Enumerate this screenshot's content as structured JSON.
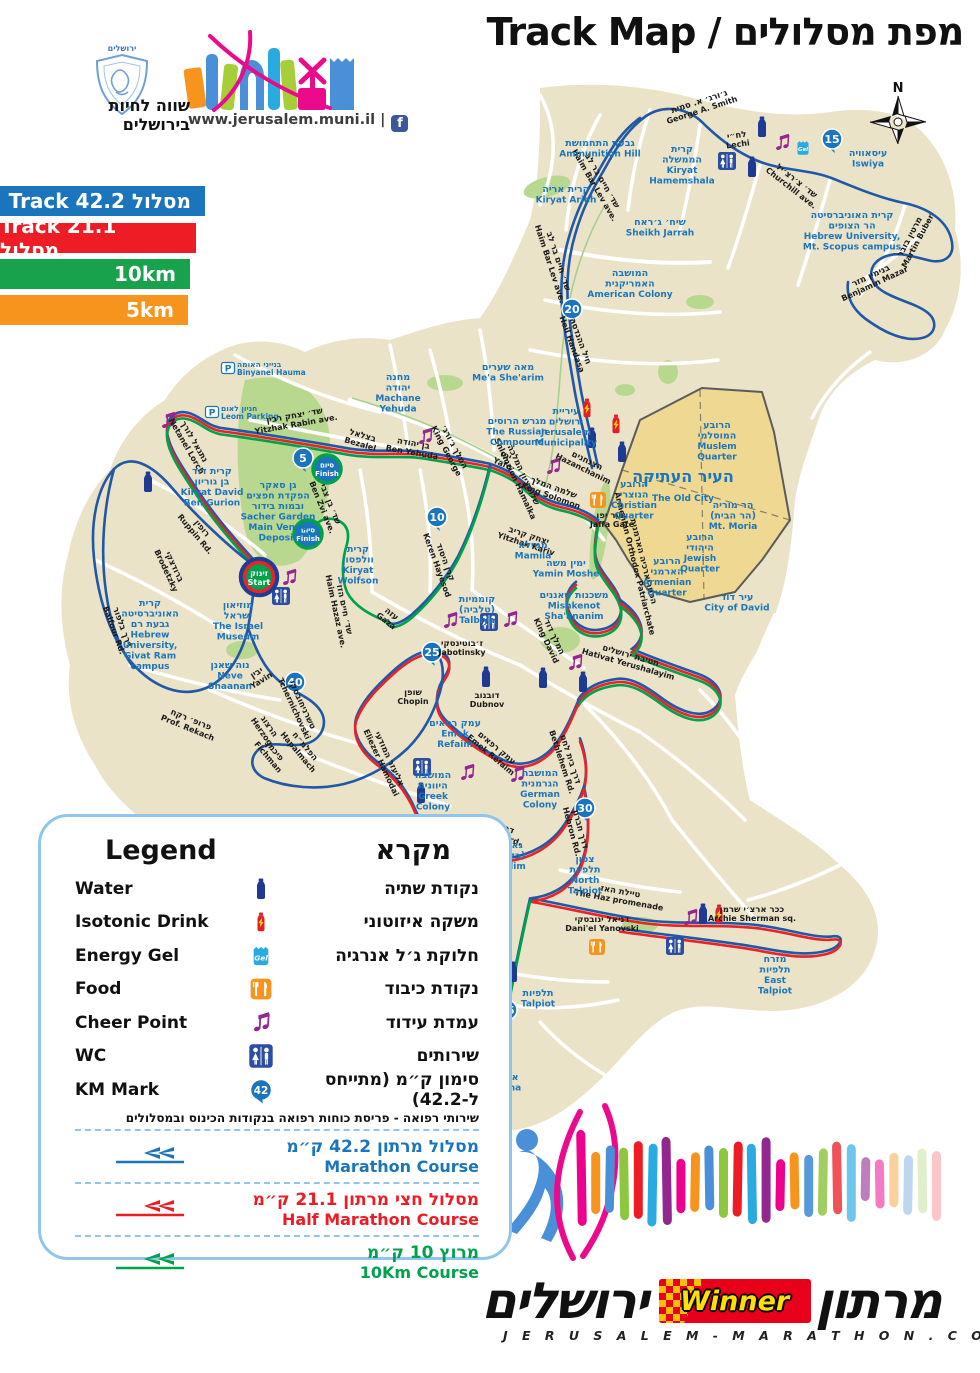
{
  "theme": {
    "map_bg": "#EBE3C8",
    "park": "#B9D88F",
    "old_city_fill": "#EFD892",
    "old_city_border": "#5B5B5B",
    "label_blue": "#1B75BC",
    "street_black": "#1A1A1A",
    "road_white": "#FFFFFF",
    "route_colors": {
      "blue": "#2158A6",
      "red": "#E8232A",
      "green": "#00A14B"
    },
    "ribbon_blue": "#1B75BC",
    "ribbon_red": "#EE1C25",
    "ribbon_green": "#18A24C",
    "ribbon_orange": "#F7941E"
  },
  "header": {
    "title": "Track Map / מפת מסלולים",
    "compass_n": "N",
    "logo_top": "ירושלים",
    "slogan_line1": "שווה לחיות",
    "slogan_line2": "בירושלים",
    "site": "www.jerusalem.muni.il |",
    "fb": "f"
  },
  "ribbons": [
    {
      "label": "Track 42.2 מסלול",
      "color": "#1B75BC",
      "width": 205,
      "top": 186
    },
    {
      "label": "Track 21.1 מסלול",
      "color": "#EE1C25",
      "width": 196,
      "top": 223
    },
    {
      "label": "10km",
      "color": "#18A24C",
      "width": 190,
      "top": 259
    },
    {
      "label": "5km",
      "color": "#F7941E",
      "width": 188,
      "top": 295
    }
  ],
  "legend": {
    "title_en": "Legend",
    "title_he": "מקרא",
    "items": [
      {
        "en": "Water",
        "he": "נקודת שתיה",
        "icon": "water"
      },
      {
        "en": "Isotonic Drink",
        "he": "משקה איזוטוני",
        "icon": "isotonic"
      },
      {
        "en": "Energy Gel",
        "he": "חלוקת ג׳ל אנרגיה",
        "icon": "gel"
      },
      {
        "en": "Food",
        "he": "נקודת כיבוד",
        "icon": "food"
      },
      {
        "en": "Cheer Point",
        "he": "עמדת עידוד",
        "icon": "cheer"
      },
      {
        "en": "WC",
        "he": "שירותים",
        "icon": "wc"
      },
      {
        "en": "KM Mark",
        "he": "סימון ק״מ (מתייחס ל-42.2)",
        "icon": "km",
        "badge": "42"
      }
    ],
    "note": "שירותי רפואה - פריסת כוחות רפואה בנקודות הכינוס ובמסלולים",
    "courses": [
      {
        "he": "מסלול מרתון 42.2 ק״מ",
        "en": "Marathon Course",
        "color": "blue"
      },
      {
        "he": "מסלול חצי מרתון 21.1 ק״מ",
        "en": "Half Marathon Course",
        "color": "red"
      },
      {
        "he": "מרוץ 10 ק״מ",
        "en": "10Km Course",
        "color": "green"
      }
    ]
  },
  "footer": {
    "brand_left": "ירושלים",
    "brand_right": "מרתון",
    "winner": "Winner",
    "url": "J E R U S A L E M - M A R A T H O N . C O M"
  },
  "map": {
    "start": {
      "x": 259,
      "y": 577,
      "he": "זינוק",
      "en": "Start"
    },
    "finishes": [
      {
        "x": 327,
        "y": 469,
        "he": "סיום",
        "en": "Finish"
      },
      {
        "x": 308,
        "y": 534,
        "he": "סיום",
        "en": "Finish"
      }
    ],
    "km_marks": [
      {
        "n": "5",
        "x": 303,
        "y": 458
      },
      {
        "n": "10",
        "x": 437,
        "y": 517
      },
      {
        "n": "15",
        "x": 832,
        "y": 139
      },
      {
        "n": "20",
        "x": 572,
        "y": 309
      },
      {
        "n": "25",
        "x": 432,
        "y": 652
      },
      {
        "n": "30",
        "x": 585,
        "y": 808
      },
      {
        "n": "35",
        "x": 507,
        "y": 1010
      },
      {
        "n": "40",
        "x": 295,
        "y": 682
      }
    ],
    "icons": [
      {
        "t": "wc",
        "x": 727,
        "y": 161
      },
      {
        "t": "wc",
        "x": 281,
        "y": 596
      },
      {
        "t": "wc",
        "x": 489,
        "y": 622
      },
      {
        "t": "wc",
        "x": 422,
        "y": 767
      },
      {
        "t": "wc",
        "x": 675,
        "y": 946
      },
      {
        "t": "water",
        "x": 762,
        "y": 127
      },
      {
        "t": "water",
        "x": 752,
        "y": 167
      },
      {
        "t": "water",
        "x": 148,
        "y": 482
      },
      {
        "t": "water",
        "x": 592,
        "y": 438
      },
      {
        "t": "water",
        "x": 622,
        "y": 452
      },
      {
        "t": "water",
        "x": 486,
        "y": 677
      },
      {
        "t": "water",
        "x": 543,
        "y": 678
      },
      {
        "t": "water",
        "x": 583,
        "y": 682
      },
      {
        "t": "water",
        "x": 421,
        "y": 793
      },
      {
        "t": "water",
        "x": 494,
        "y": 963
      },
      {
        "t": "water",
        "x": 513,
        "y": 972
      },
      {
        "t": "water",
        "x": 703,
        "y": 914
      },
      {
        "t": "isotonic",
        "x": 587,
        "y": 408
      },
      {
        "t": "isotonic",
        "x": 616,
        "y": 424
      },
      {
        "t": "isotonic",
        "x": 719,
        "y": 914
      },
      {
        "t": "gel",
        "x": 803,
        "y": 148
      },
      {
        "t": "gel",
        "x": 428,
        "y": 821
      },
      {
        "t": "food",
        "x": 598,
        "y": 500
      },
      {
        "t": "food",
        "x": 597,
        "y": 947
      },
      {
        "t": "cheer",
        "x": 782,
        "y": 143
      },
      {
        "t": "cheer",
        "x": 168,
        "y": 421
      },
      {
        "t": "cheer",
        "x": 289,
        "y": 578
      },
      {
        "t": "cheer",
        "x": 425,
        "y": 437
      },
      {
        "t": "cheer",
        "x": 553,
        "y": 467
      },
      {
        "t": "cheer",
        "x": 450,
        "y": 621
      },
      {
        "t": "cheer",
        "x": 510,
        "y": 620
      },
      {
        "t": "cheer",
        "x": 467,
        "y": 773
      },
      {
        "t": "cheer",
        "x": 517,
        "y": 775
      },
      {
        "t": "cheer",
        "x": 575,
        "y": 663
      },
      {
        "t": "cheer",
        "x": 500,
        "y": 908
      },
      {
        "t": "cheer",
        "x": 690,
        "y": 918
      }
    ],
    "parkings": [
      {
        "x": 228,
        "y": 368,
        "he": "בנייני האומה",
        "en": "Binyanei Hauma"
      },
      {
        "x": 212,
        "y": 412,
        "he": "חניון לאום",
        "en": "Leom Parking"
      }
    ],
    "places": [
      {
        "x": 600,
        "y": 146,
        "he": [
          "גבעת התחמושת"
        ],
        "en": [
          "Ammunition Hill"
        ]
      },
      {
        "x": 566,
        "y": 192,
        "he": [
          "קרית אריה"
        ],
        "en": [
          "Kiryat Arieh"
        ]
      },
      {
        "x": 682,
        "y": 152,
        "he": [
          "קרית",
          "הממשלה"
        ],
        "en": [
          "Kiryat",
          "Hamemshala"
        ]
      },
      {
        "x": 660,
        "y": 225,
        "he": [
          "שיח׳ ג׳ראח"
        ],
        "en": [
          "Sheikh Jarrah"
        ]
      },
      {
        "x": 630,
        "y": 276,
        "he": [
          "המושבה",
          "האמריקנית"
        ],
        "en": [
          "American Colony"
        ]
      },
      {
        "x": 868,
        "y": 156,
        "he": [
          "עיסאוויה"
        ],
        "en": [
          "Iswiya"
        ]
      },
      {
        "x": 852,
        "y": 218,
        "he": [
          "קרית האוניברסיטה",
          "הר הצופים"
        ],
        "en": [
          "Hebrew University,",
          "Mt. Scopus campus"
        ]
      },
      {
        "x": 508,
        "y": 370,
        "he": [
          "מאה שערים"
        ],
        "en": [
          "Me'a She'arim"
        ]
      },
      {
        "x": 398,
        "y": 380,
        "he": [
          "מחנה",
          "יהודה"
        ],
        "en": [
          "Machane",
          "Yehuda"
        ]
      },
      {
        "x": 517,
        "y": 424,
        "he": [
          "מגרש הרוסים"
        ],
        "en": [
          "The Russian",
          "Compound"
        ]
      },
      {
        "x": 566,
        "y": 414,
        "he": [
          "עיריית",
          "ירושלים"
        ],
        "en": [
          "Jerusalem",
          "Municipality"
        ]
      },
      {
        "x": 683,
        "y": 482,
        "big": true,
        "he": [
          "העיר העתיקה"
        ],
        "en": [
          "The Old City"
        ]
      },
      {
        "x": 717,
        "y": 428,
        "he": [
          "הרובע",
          "המוסלמי"
        ],
        "en": [
          "Muslem",
          "Quarter"
        ]
      },
      {
        "x": 634,
        "y": 487,
        "he": [
          "הרובע",
          "הנוצרי"
        ],
        "en": [
          "Christian",
          "Quarter"
        ]
      },
      {
        "x": 733,
        "y": 508,
        "he": [
          "הר מוריה",
          "(הר הבית)"
        ],
        "en": [
          "Mt. Moria"
        ]
      },
      {
        "x": 700,
        "y": 540,
        "he": [
          "הרובע",
          "היהודי"
        ],
        "en": [
          "Jewish",
          "Quarter"
        ]
      },
      {
        "x": 667,
        "y": 564,
        "he": [
          "הרובע",
          "הארמני"
        ],
        "en": [
          "Armenian",
          "Quarter"
        ]
      },
      {
        "x": 737,
        "y": 600,
        "he": [
          "עיר דוד"
        ],
        "en": [
          "City of David"
        ]
      },
      {
        "x": 212,
        "y": 474,
        "he": [
          "קרית דוד",
          "בן גוריון"
        ],
        "en": [
          "Kiryat David",
          "Ben Gurion"
        ]
      },
      {
        "x": 278,
        "y": 488,
        "he": [
          "גן סאקר",
          "הפקדת חפצים",
          "ובמות בידור"
        ],
        "en": [
          "Sacher Garden",
          "Main Venue",
          "Deposit"
        ]
      },
      {
        "x": 358,
        "y": 552,
        "he": [
          "קרית",
          "וולפסון"
        ],
        "en": [
          "Kiryat",
          "Wolfson"
        ]
      },
      {
        "x": 533,
        "y": 548,
        "he": [
          "ממילא"
        ],
        "en": [
          "Mamila"
        ]
      },
      {
        "x": 566,
        "y": 566,
        "he": [
          "ימין משה"
        ],
        "en": [
          "Yamin Moshe"
        ]
      },
      {
        "x": 574,
        "y": 598,
        "he": [
          "משכנות שאננים"
        ],
        "en": [
          "Mishkenot",
          "Sha'ananim"
        ]
      },
      {
        "x": 477,
        "y": 602,
        "he": [
          "קוממיות",
          "(טלביה)"
        ],
        "en": [
          "Talbiya"
        ]
      },
      {
        "x": 238,
        "y": 608,
        "he": [
          "מוזיאון",
          "ישראל"
        ],
        "en": [
          "The Israel",
          "Museum"
        ]
      },
      {
        "x": 150,
        "y": 606,
        "he": [
          "קרית",
          "האוניברסיטה",
          "גבעת רם"
        ],
        "en": [
          "Hebrew",
          "University,",
          "Givat Ram",
          "campus"
        ]
      },
      {
        "x": 230,
        "y": 668,
        "he": [
          "נוה שאנן"
        ],
        "en": [
          "Neve",
          "Shaanan"
        ]
      },
      {
        "x": 455,
        "y": 726,
        "he": [
          "עמק רפאים"
        ],
        "en": [
          "Emek",
          "Refaim"
        ]
      },
      {
        "x": 433,
        "y": 778,
        "he": [
          "המושבה",
          "היוונית"
        ],
        "en": [
          "Greek",
          "Colony"
        ]
      },
      {
        "x": 540,
        "y": 776,
        "he": [
          "המושבה",
          "הגרמנית"
        ],
        "en": [
          "German",
          "Colony"
        ]
      },
      {
        "x": 508,
        "y": 848,
        "he": [
          "גאולים",
          "(בקעה)"
        ],
        "en": [
          "Geulim"
        ]
      },
      {
        "x": 585,
        "y": 862,
        "he": [
          "צפון",
          "תלפיות"
        ],
        "en": [
          "North",
          "Talpiot"
        ]
      },
      {
        "x": 538,
        "y": 996,
        "he": [
          "תלפיות"
        ],
        "en": [
          "Talpiot"
        ]
      },
      {
        "x": 775,
        "y": 962,
        "he": [
          "מזרח",
          "תלפיות"
        ],
        "en": [
          "East",
          "Talpiot"
        ]
      },
      {
        "x": 503,
        "y": 1080,
        "he": [
          "ארנונה"
        ],
        "en": [
          "Arnona"
        ]
      }
    ],
    "streets": [
      {
        "x": 700,
        "y": 104,
        "r": -18,
        "he": "ג׳ורג׳ א. סמית",
        "en": "George A. Smith"
      },
      {
        "x": 737,
        "y": 138,
        "r": -8,
        "he": "לח״י",
        "en": "Lechi"
      },
      {
        "x": 600,
        "y": 182,
        "r": 60,
        "he": "שד׳ חיים בר לב",
        "en": "Haim Bar Lev ave."
      },
      {
        "x": 795,
        "y": 183,
        "r": 38,
        "he": "שד׳ צ׳רצ׳יל",
        "en": "Churchill ave."
      },
      {
        "x": 872,
        "y": 278,
        "r": -25,
        "he": "בנימין מזר",
        "en": "Benjamin Mazar"
      },
      {
        "x": 912,
        "y": 238,
        "r": -62,
        "he": "מרטין בובר",
        "en": "Martin Buber"
      },
      {
        "x": 578,
        "y": 342,
        "r": 70,
        "he": "חיל ההנדסה",
        "en": "Heil Handasa"
      },
      {
        "x": 556,
        "y": 262,
        "r": 72,
        "he": "שד׳ חיים בר לב",
        "en": "Haim Bar Lev ave."
      },
      {
        "x": 295,
        "y": 418,
        "r": -10,
        "he": "שד׳ יצחק רבין",
        "en": "Yitzhak Rabin ave."
      },
      {
        "x": 192,
        "y": 443,
        "r": 60,
        "he": "נתנאל לורך",
        "en": "Netanel Lorch"
      },
      {
        "x": 200,
        "y": 530,
        "r": 50,
        "he": "רופין",
        "en": "Ruppin Rd."
      },
      {
        "x": 172,
        "y": 568,
        "r": 65,
        "he": "ברודצקי",
        "en": "Brodetzky"
      },
      {
        "x": 120,
        "y": 628,
        "r": 70,
        "he": "דרך בלפור",
        "en": "Balfour Rd."
      },
      {
        "x": 362,
        "y": 438,
        "r": 16,
        "he": "בצלאל",
        "en": "Bezalel"
      },
      {
        "x": 413,
        "y": 446,
        "r": 10,
        "he": "בן יהודה",
        "en": "Ben Yehuda"
      },
      {
        "x": 452,
        "y": 448,
        "r": 62,
        "he": "המלך ג׳ורג׳",
        "en": "King George"
      },
      {
        "x": 505,
        "y": 458,
        "r": 24,
        "he": "יפו",
        "en": "Yafo"
      },
      {
        "x": 521,
        "y": 476,
        "r": 65,
        "he": "שלומציון המלכה",
        "en": "Shlomzion Hamalka"
      },
      {
        "x": 553,
        "y": 490,
        "r": 20,
        "he": "שלמה המלך",
        "en": "King Solomon"
      },
      {
        "x": 586,
        "y": 463,
        "r": 26,
        "he": "הצנחנים",
        "en": "Hazanchanim"
      },
      {
        "x": 612,
        "y": 518,
        "r": 0,
        "he": "שער יפו",
        "en": "Jaffa Gate"
      },
      {
        "x": 528,
        "y": 538,
        "r": 18,
        "he": "יצחק קריב",
        "en": "Yitzhak Kariv"
      },
      {
        "x": 641,
        "y": 562,
        "r": 76,
        "he": "הפטריארכיה הארמנית",
        "en": "Armenian Orthodox Patriarchate"
      },
      {
        "x": 443,
        "y": 563,
        "r": 70,
        "he": "קרן היסוד",
        "en": "Keren Hayesod"
      },
      {
        "x": 390,
        "y": 616,
        "r": 38,
        "he": "עזה",
        "en": "Gaza"
      },
      {
        "x": 342,
        "y": 610,
        "r": 78,
        "he": "שד׳ חיים הזז",
        "en": "Haim Hazaz ave."
      },
      {
        "x": 328,
        "y": 505,
        "r": 68,
        "he": "שד׳ בן צבי",
        "en": "Ben Zvi ave."
      },
      {
        "x": 462,
        "y": 646,
        "r": 0,
        "he": "ז׳בוטינסקי",
        "en": "Jabotinsky"
      },
      {
        "x": 413,
        "y": 695,
        "r": 0,
        "he": "שופן",
        "en": "Chopin"
      },
      {
        "x": 487,
        "y": 698,
        "r": 0,
        "he": "דובנוב",
        "en": "Dubnov"
      },
      {
        "x": 258,
        "y": 675,
        "r": -32,
        "he": "יבין",
        "en": "Yavin"
      },
      {
        "x": 300,
        "y": 706,
        "r": 65,
        "he": "טשרניחובסקי",
        "en": "Tchernichovski"
      },
      {
        "x": 267,
        "y": 728,
        "r": 55,
        "he": "הרצוג",
        "en": "Herzog"
      },
      {
        "x": 273,
        "y": 753,
        "r": 50,
        "he": "פיכמן",
        "en": "Fichman"
      },
      {
        "x": 303,
        "y": 748,
        "r": 50,
        "he": "הפלמ״ח",
        "en": "Hapalmach"
      },
      {
        "x": 190,
        "y": 722,
        "r": 22,
        "he": "פרופ׳ רקח",
        "en": "Prof. Rekach"
      },
      {
        "x": 387,
        "y": 760,
        "r": 65,
        "he": "אליעזר המודעי",
        "en": "Eliezer Hamodai"
      },
      {
        "x": 495,
        "y": 750,
        "r": 40,
        "he": "עמק רפאים",
        "en": "Emek Refaim"
      },
      {
        "x": 492,
        "y": 826,
        "r": 20,
        "he": "דרך הרכבת",
        "en": "Ha-Rakevet rd."
      },
      {
        "x": 568,
        "y": 760,
        "r": 72,
        "he": "דרך בית לחם",
        "en": "Bethlehem Rd."
      },
      {
        "x": 578,
        "y": 830,
        "r": 75,
        "he": "דרך חברון",
        "en": "Hebron Rd."
      },
      {
        "x": 552,
        "y": 638,
        "r": 65,
        "he": "המלך דוד",
        "en": "King David"
      },
      {
        "x": 630,
        "y": 658,
        "r": 16,
        "he": "חטיבת ירושלים",
        "en": "Hativat Yerushalayim"
      },
      {
        "x": 620,
        "y": 894,
        "r": 10,
        "he": "טיילת האז",
        "en": "The Haz promenade"
      },
      {
        "x": 602,
        "y": 922,
        "r": 0,
        "he": "דניאל ינובסקי",
        "en": "Dani'el Yanovski"
      },
      {
        "x": 752,
        "y": 912,
        "r": 0,
        "he": "ככר ארצ׳י שרמן",
        "en": "Archie Sherman sq."
      },
      {
        "x": 477,
        "y": 888,
        "r": 12,
        "he": "יהודה",
        "en": "Yehuda"
      },
      {
        "x": 500,
        "y": 1036,
        "r": 70,
        "he": "דרך חברון",
        "en": "Hebron Rd."
      },
      {
        "x": 440,
        "y": 1096,
        "r": 8,
        "he": "דרך משה ברעם",
        "en": "Moshe Baram Rd."
      }
    ]
  }
}
